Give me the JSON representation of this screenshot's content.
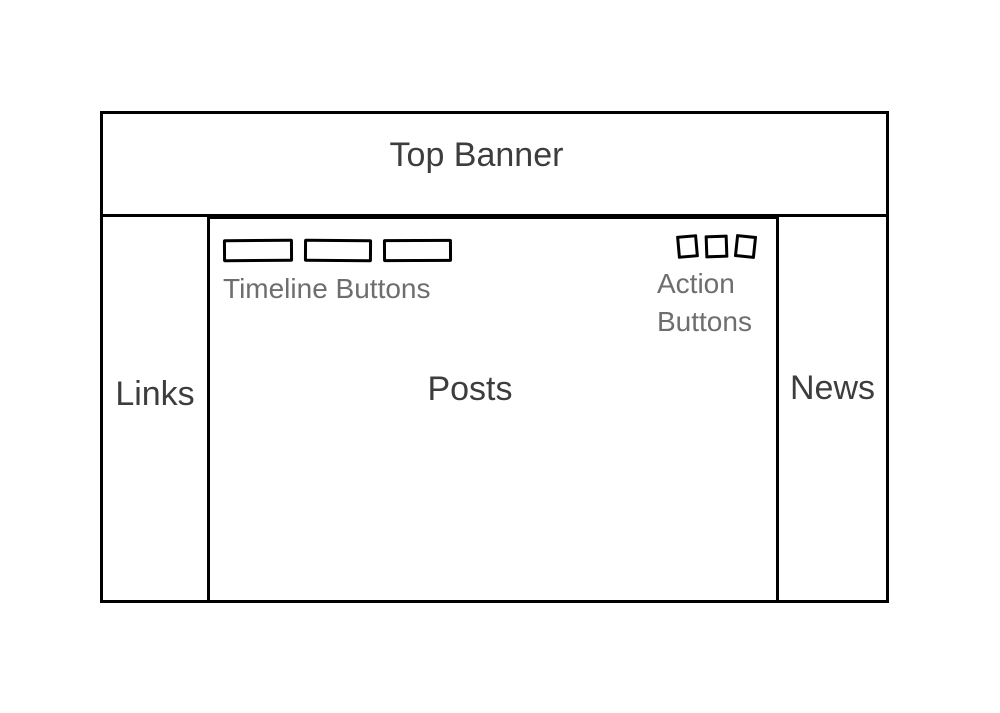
{
  "page": {
    "background": "#ffffff"
  },
  "colors": {
    "stroke": "#000000",
    "heading_text": "#3d3d3d",
    "caption_text": "#6e6e6e"
  },
  "wireframe": {
    "banner": {
      "label": "Top Banner"
    },
    "sidebar_left": {
      "label": "Links"
    },
    "main": {
      "label": "Posts",
      "timeline_buttons": {
        "label": "Timeline Buttons",
        "count": 3
      },
      "action_buttons": {
        "label_line1": "Action",
        "label_line2": "Buttons",
        "count": 3
      }
    },
    "sidebar_right": {
      "label": "News"
    }
  }
}
